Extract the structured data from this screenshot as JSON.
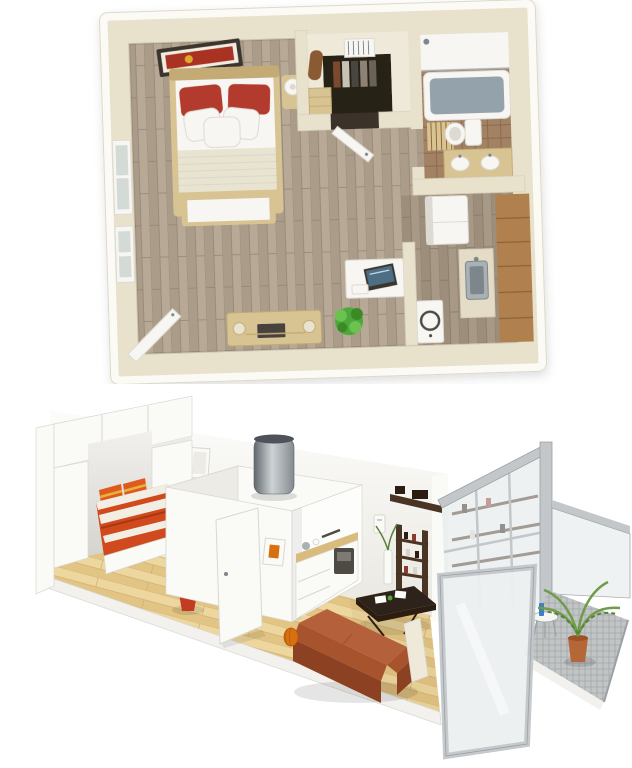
{
  "meta": {
    "description": "Two 3D renders of a small studio apartment stacked vertically: a top-down 3D floor plan above and an isometric cutaway view below",
    "width_px": 632,
    "height_px": 768
  },
  "palette": {
    "bg": "#ffffff",
    "plan_outer": "#fbfaf5",
    "plan_edge": "#ddd8c8",
    "plan_wall": "#e8e1cc",
    "plan_wall_shade": "#d7d0b9",
    "wood": "#ab9c8a",
    "wood_light": "#b8a997",
    "wood_line": "#8f8170",
    "vest_floor": "#efe9d9",
    "closet_dark": "#262019",
    "bath_floor": "#a28263",
    "bath_line": "#8a6b4e",
    "tub_water": "#94a2ab",
    "white_fix": "#f7f6f3",
    "fix_shade": "#dcdad2",
    "tan": "#d8c493",
    "tan_dark": "#c4ab74",
    "red_pillow": "#b23a2d",
    "art_red": "#a93320",
    "frame_dark": "#3a352e",
    "cream_blanket": "#e9e4cf",
    "tv_dark": "#46423c",
    "green": "#4ea83a",
    "green_dark": "#3a8a28",
    "green_light": "#6cc251",
    "cab_wood": "#b08150",
    "cab_line": "#8d6236",
    "steel": "#a9b1b5",
    "steel_dark": "#7c868c",
    "iso_wall": "#f6f5f1",
    "iso_wall_shade": "#e9e7e1",
    "iso_white": "#fafaf7",
    "iso_white_shade": "#ecebe6",
    "iso_edge": "#d9d7d1",
    "slab": "#f2f1ed",
    "iso_floor": "#eed79e",
    "iso_floor_stripe": "#e2c584",
    "iso_floor_line": "#cfb173",
    "duvet": "#d04a1d",
    "duvet_dark": "#a93811",
    "duvet_white": "#f3eee3",
    "pillow_orange": "#e05a20",
    "pillow_yellow": "#e3b43c",
    "counter_wood": "#dabb7e",
    "appliance": "#4e4a44",
    "sofa": "#a7532e",
    "sofa_dark": "#8c4122",
    "sofa_light": "#b4603a",
    "cushion": "#efe9da",
    "table_dark": "#2d231b",
    "shelf_brown": "#4a3423",
    "shelf_dark": "#2c1d10",
    "pot_red": "#c33b20",
    "terracotta": "#b56737",
    "palm": "#6f9c48",
    "palm_dark": "#56823a",
    "metal": "#c3c7ca",
    "metal_dark": "#9aa0a4",
    "frost": "#edf0f1",
    "glass": "#dfe6e8",
    "grate": "#c2c5c5",
    "grate_line": "#a2a7a7",
    "gourd": "#d9700f",
    "blue": "#3e7fc1"
  },
  "scenes": {
    "floor_plan": {
      "label": "3D top-view floor plan of a studio apartment",
      "objects": [
        "double-bed with red pillows",
        "wall art frame",
        "nightstand with lamp",
        "two windows",
        "entry vestibule with dark closet and hanger rack",
        "open entry door",
        "bathroom: shower, tub, toilet, double-sink vanity, slat mat",
        "kitchen: fridge, wood cabinets, sink counter, washing machine",
        "desk with monitor",
        "media console with speakers",
        "green plant",
        "open balcony door"
      ]
    },
    "isometric": {
      "label": "3D isometric cutaway of a studio apartment",
      "objects": [
        "white wardrobe over bed nook",
        "bed with orange striped duvet",
        "potted plant in red pot",
        "white kitchen island with steel extractor chimney",
        "small framed artworks",
        "open white door",
        "kitchenette with wood counter and oven",
        "terracotta sofa with white pillow",
        "dark coffee table",
        "dark wood shelving unit",
        "wall intercom",
        "glass and aluminum partition",
        "frosted glass panel",
        "balcony with metal grate floor",
        "palm plant in terracotta pot",
        "small bistro table with blue bottle"
      ]
    }
  }
}
